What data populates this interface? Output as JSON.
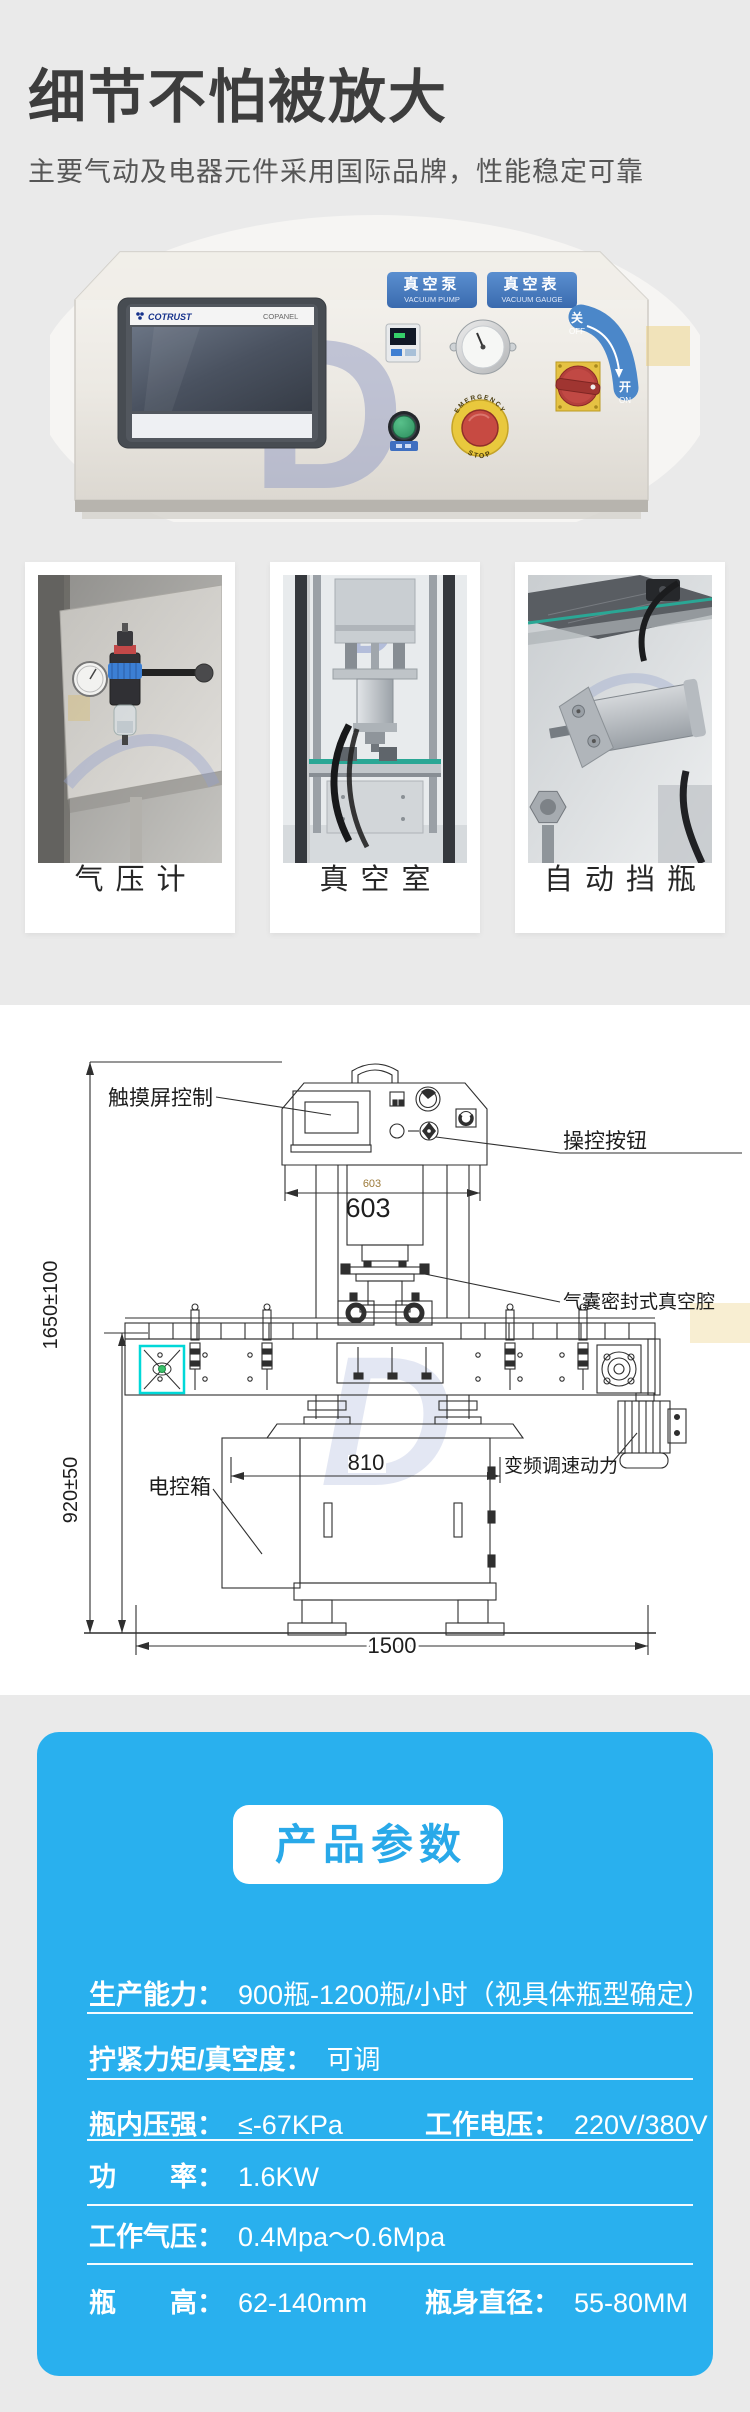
{
  "colors": {
    "accent_blue": "#29b0ee",
    "title_blue": "#29a9e9",
    "badge_blue": "#4a7fc1",
    "highlight_cyan": "#00d8d8",
    "page_bg": "#eaeaea"
  },
  "header": {
    "title": "细节不怕被放大",
    "subtitle": "主要气动及电器元件采用国际品牌，性能稳定可靠"
  },
  "panel_photo": {
    "hmi_brand": "COTRUST",
    "hmi_model": "COPANEL",
    "badge_pump": {
      "cn": "真空泵",
      "en": "VACUUM PUMP"
    },
    "badge_gauge": {
      "cn": "真空表",
      "en": "VACUUM GAUGE"
    },
    "switch": {
      "off_cn": "关",
      "off_en": "OFF",
      "on_cn": "开",
      "on_en": "ON"
    },
    "estop": {
      "line1": "EMERGENCY",
      "line2": "STOP"
    },
    "watermark": "D"
  },
  "feature_cards": [
    {
      "caption": "气压计"
    },
    {
      "caption": "真空室"
    },
    {
      "caption": "自动挡瓶"
    }
  ],
  "diagram": {
    "labels": {
      "touchscreen": "触摸屏控制",
      "control_buttons": "操控按钮",
      "vacuum_chamber": "气囊密封式真空腔",
      "electric_box": "电控箱",
      "vfd_motor": "变频调速动力"
    },
    "dimensions": {
      "total_height": "1650±100",
      "conveyor_height": "920±50",
      "head_width_small": "603",
      "head_width": "603",
      "body_width": "810",
      "total_width": "1500"
    },
    "watermark": "D"
  },
  "params": {
    "title": "产品参数",
    "rows": [
      {
        "cells": [
          {
            "label": "生产能力：",
            "value": "900瓶-1200瓶/小时（视具体瓶型确定）"
          }
        ]
      },
      {
        "cells": [
          {
            "label": "拧紧力矩/真空度：",
            "value": "可调"
          }
        ]
      },
      {
        "cells": [
          {
            "label": "瓶内压强：",
            "value": "≤-67KPa"
          },
          {
            "label": "工作电压：",
            "value": "220V/380V"
          }
        ]
      },
      {
        "cells": [
          {
            "label": "功　　率：",
            "value": "1.6KW"
          }
        ]
      },
      {
        "cells": [
          {
            "label": "工作气压：",
            "value": "0.4Mpa～0.6Mpa"
          }
        ]
      },
      {
        "cells": [
          {
            "label": "瓶　　高：",
            "value": "62-140mm"
          },
          {
            "label": "瓶身直径：",
            "value": "55-80MM"
          }
        ]
      }
    ]
  }
}
